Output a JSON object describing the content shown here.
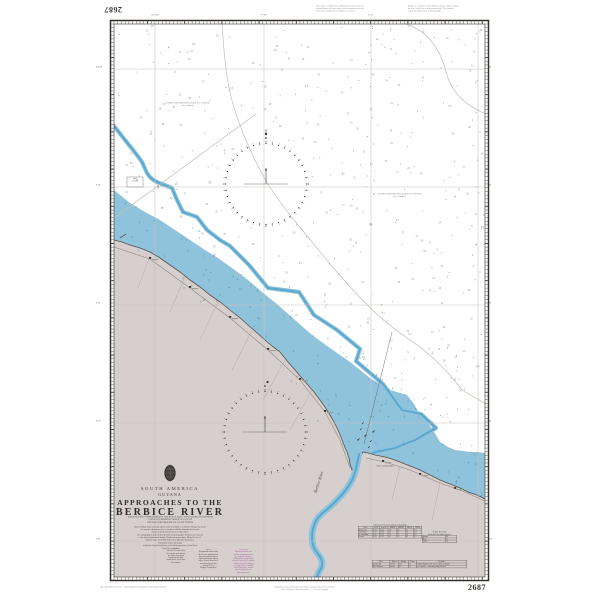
{
  "chart": {
    "number": "2687",
    "corner_number_top_left": "2687",
    "corner_number_bottom_right": "2687",
    "title_block": {
      "region": "SOUTH AMERICA",
      "country": "GUYANA",
      "title_line1": "APPROACHES TO THE",
      "title_line2": "BERBICE RIVER",
      "subtitle_lines": [
        "SURVEYED BY COMMANDERS OF THE ROYAL NAVY, WITH CORRECTIONS FROM",
        "LATER GOVERNMENT SURVEYS TO DATE",
        "DEPTHS IN METRES BELOW CHART DATUM"
      ],
      "caution_lines": [
        "Banks of Mud, Sand and Clay off this coast are liable to continual change; the buoys",
        "are moved, when necessary, to conform with the channels and are not",
        "always in the positions shown on this chart."
      ],
      "datum_lines": [
        "The topography is derived chiefly from air photographs. Positions are referred",
        "to the local astronomical datum. Heights in metres above Mean Sea Level.",
        "Natural Scale 1:100 000 (Lat 6°15′). Mercator Projection."
      ],
      "publication_lines": [
        "Published at the Admiralty",
        "under the Superintendence of the Hydrographer of the Navy.",
        "Small corrections"
      ]
    },
    "sea_labels": [
      {
        "line1": "BANKS AND DEPTHS LIABLE TO CHANGE",
        "line2": "(see Caution)"
      },
      {
        "line1": "BANKS AND DEPTHS LIABLE TO CHANGE",
        "line2": "(see Caution)"
      }
    ],
    "box_label_lines": [
      "Spoil",
      "Ground"
    ],
    "place_labels": {
      "river": "Berbice River",
      "town": "New Amsterdam"
    },
    "border_labels": {
      "top": [
        "57°30′W",
        "57°20′",
        "57°10′"
      ],
      "left": [
        "6°40′N",
        "6°30′",
        "6°20′",
        "6°10′",
        "6°00′"
      ],
      "right": [
        "40′",
        "30′",
        "20′",
        "10′",
        "6°N"
      ]
    },
    "notes": {
      "col1": {
        "heading": "CAUTION",
        "lines": [
          "Mariners are warned that",
          "the outer bar and channels",
          "are subject to frequent",
          "change and the chart",
          "should not be relied upon",
          "close inshore."
        ]
      },
      "col2": {
        "heading": "NOTES",
        "lines": [
          "Navigational marks within",
          "the river are maintained by",
          "the local authority and are",
          "liable to alteration without",
          "notice. Vessels should seek",
          "local knowledge before",
          "entering the river.",
          "Pilotage is compulsory."
        ]
      },
      "col3": {
        "heading": "POSITIONS",
        "lines": [
          "Positions obtained from",
          "satellite navigation systems",
          "are normally referred to",
          "WGS Datum; such positions",
          "should be moved 0.05 minutes",
          "southward and 0.08 minutes",
          "westward to agree with this",
          "chart. Mariners are warned",
          "that charted limits are",
          "approximate only."
        ]
      }
    },
    "tables": {
      "tidal": {
        "title": "Tidal Levels referred to Datum of Soundings",
        "headers": [
          "Place",
          "Lat N",
          "Long W",
          "MHWS",
          "MHWN",
          "MLWN",
          "MLWS"
        ],
        "rows": [
          [
            "Berbice Ent.",
            "6°21′",
            "57°31′",
            "2.9",
            "2.3",
            "1.1",
            "0.4"
          ],
          [
            "Crab Island",
            "6°17′",
            "57°30′",
            "2.8",
            "2.2",
            "1.0",
            "0.4"
          ],
          [
            "N. Amsterdam",
            "6°15′",
            "57°31′",
            "2.7",
            "2.1",
            "1.0",
            "0.3"
          ],
          [
            "Everton",
            "6°10′",
            "57°32′",
            "2.6",
            "2.0",
            "0.9",
            "0.3"
          ]
        ]
      },
      "secondary": {
        "title_lines": [
          "Berbice River Bar",
          "Predicted least depths (metres)"
        ],
        "rows": [
          [
            "Springs",
            "3.4"
          ],
          [
            "Mean",
            "3.1"
          ],
          [
            "Neaps",
            "2.8"
          ]
        ]
      },
      "wide": {
        "headers": [
          "Place",
          "Datum",
          "Springs",
          "Neaps",
          "Remarks"
        ],
        "rows": [
          [
            "Berbice Bar",
            "metres",
            "2.9",
            "2.3",
            "Charted depths on the bar are liable to change"
          ],
          [
            "River Entrance",
            "metres",
            "2.7",
            "2.1",
            "see Caution — local knowledge advised"
          ]
        ]
      }
    }
  },
  "margin": {
    "top_right_block1_lines": [
      "This chart is compiled from British Government surveys",
      "with additions and corrections from information received",
      "to the date of publication. Depths are in metres."
    ],
    "top_right_block2_lines": [
      "Depths are reduced to Chart Datum, which is approximately",
      "the level of the lowest astronomical tide. The coastline",
      "is derived chiefly from air photographs."
    ],
    "bottom_left_line": "Copyright reserved — Hydrographic Department, Admiralty, Taunton.",
    "bottom_center_lines": [
      "Reproduced from Admiralty Chart 2687 by permission of the Controller",
      "of Her Majesty's Stationery Office — Crown Copyright."
    ],
    "anchor_icon": "⚓"
  },
  "colors": {
    "land": "#d7cfce",
    "shallow_water": "#8fc3dc",
    "channel_blue": "#58a8ce",
    "ink": "#2b2724",
    "coast": "#56504b",
    "magenta_note": "#9c5498",
    "grid": "#c9c2bb",
    "faint_line": "#c4bdb5",
    "speck_sea": "#8f8f8c",
    "speck_blue": "#47809f"
  }
}
